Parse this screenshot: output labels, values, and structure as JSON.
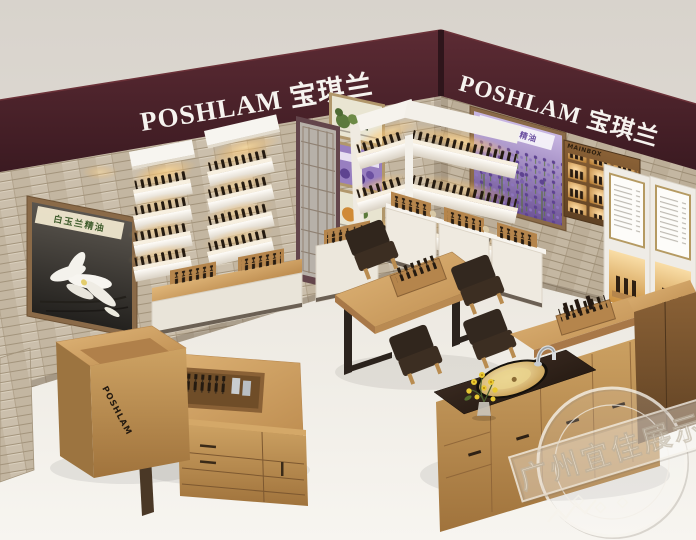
{
  "signage": {
    "left_fascia": "POSHLAM 宝琪兰",
    "right_fascia": "POSHLAM 宝琪兰",
    "reception_desk_logo": "POSHLAM",
    "wall_cabinet_label": "MAINBOX"
  },
  "posters": {
    "magnolia_title": "白玉兰精油",
    "lavender_title": "薰衣草精油"
  },
  "watermark": {
    "text": "广州宜佳展示"
  },
  "colors": {
    "fascia": "#46222b",
    "stone_wall": "#c8bcaa",
    "wood_light": "#c2945c",
    "wood_dark": "#6f4c27",
    "floor": "#f2efe9",
    "chair": "#33281f",
    "warm_glow": "#ffc878",
    "lavender": "#8a6fc0",
    "sink_gold": "#d8ae60"
  }
}
